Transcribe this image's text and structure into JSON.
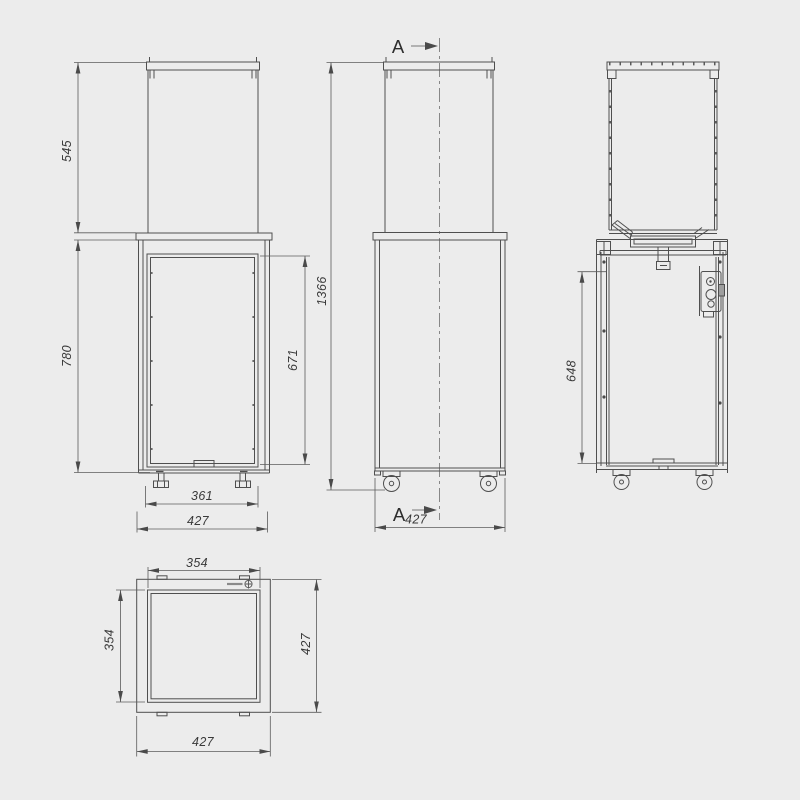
{
  "drawing": {
    "background_color": "#ececec",
    "line_color": "#4f4f4f",
    "views": {
      "front": {
        "dims": {
          "glass_height": "545",
          "body_height": "780",
          "door_height": "671",
          "feet_spacing": "361",
          "width": "427"
        }
      },
      "side": {
        "section_label": "A",
        "dims": {
          "total_height": "1366",
          "depth": "427"
        }
      },
      "section": {
        "dims": {
          "cavity_height": "648"
        }
      },
      "plan": {
        "dims": {
          "inner_width": "354",
          "inner_depth": "354",
          "outer_depth": "427",
          "outer_width": "427"
        }
      }
    }
  }
}
